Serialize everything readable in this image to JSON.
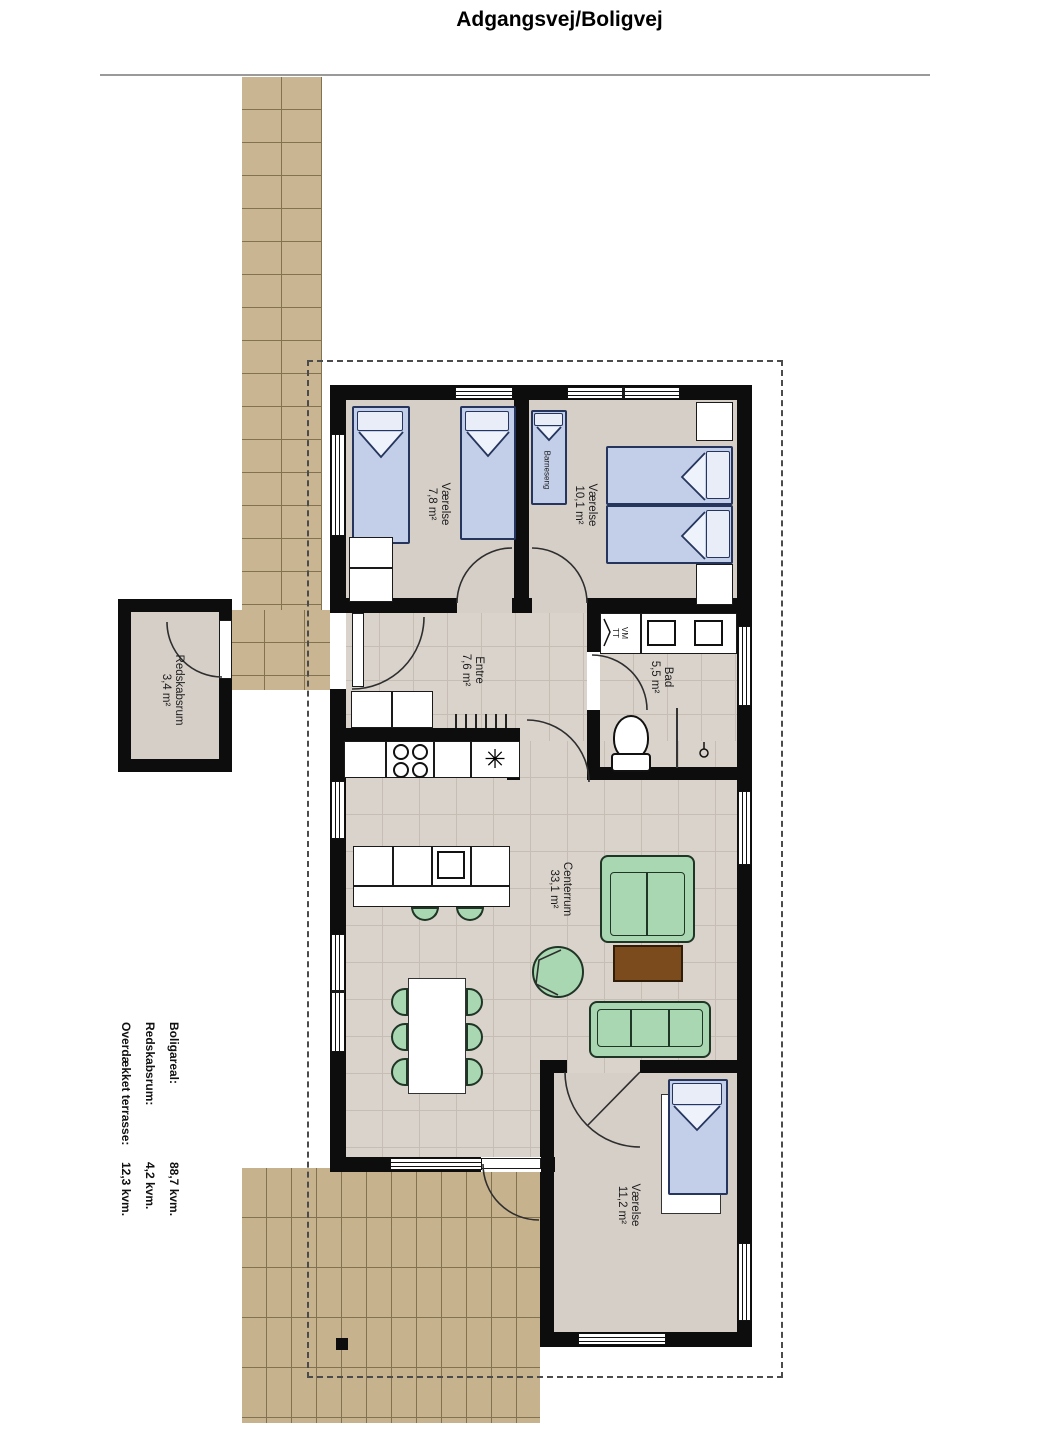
{
  "title": "Adgangsvej/Boligvej",
  "rooms": {
    "bedroom1": {
      "name": "Værelse",
      "area": "7,8 m²"
    },
    "bedroom2": {
      "name": "Værelse",
      "area": "10,1 m²"
    },
    "crib_label": "Barneseng",
    "entre": {
      "name": "Entre",
      "area": "7,6 m²"
    },
    "bath": {
      "name": "Bad",
      "area": "5,5 m²"
    },
    "livingroom": {
      "name": "Centerrum",
      "area": "33,1 m²"
    },
    "bedroom3": {
      "name": "Værelse",
      "area": "11,2 m²"
    },
    "shed": {
      "name": "Redskabsrum",
      "area": "3,4 m²"
    },
    "washer_line1": "VM",
    "washer_line2": "TT"
  },
  "kitchen": {
    "sink_symbol": "✳"
  },
  "stats": {
    "rows": [
      {
        "label": "Boligareal:",
        "value": "88,7 kvm."
      },
      {
        "label": "Redskabsrum:",
        "value": "4,2 kvm."
      },
      {
        "label": "Overdækket terrasse:",
        "value": "12,3 kvm."
      }
    ]
  },
  "colors": {
    "wall": "#0d0d0d",
    "floor_beige": "#d6cfc8",
    "tile_line": "#c6beb4",
    "brick": "#c9b592",
    "brick_line": "#82724f",
    "bed_blue": "#c3cfe9",
    "bed_outline": "#25355e",
    "furniture_green": "#a9d7b1",
    "furniture_green_outline": "#1f3526",
    "table_brown": "#7b4a1d",
    "boundary_dash": "#4b4b4b"
  }
}
